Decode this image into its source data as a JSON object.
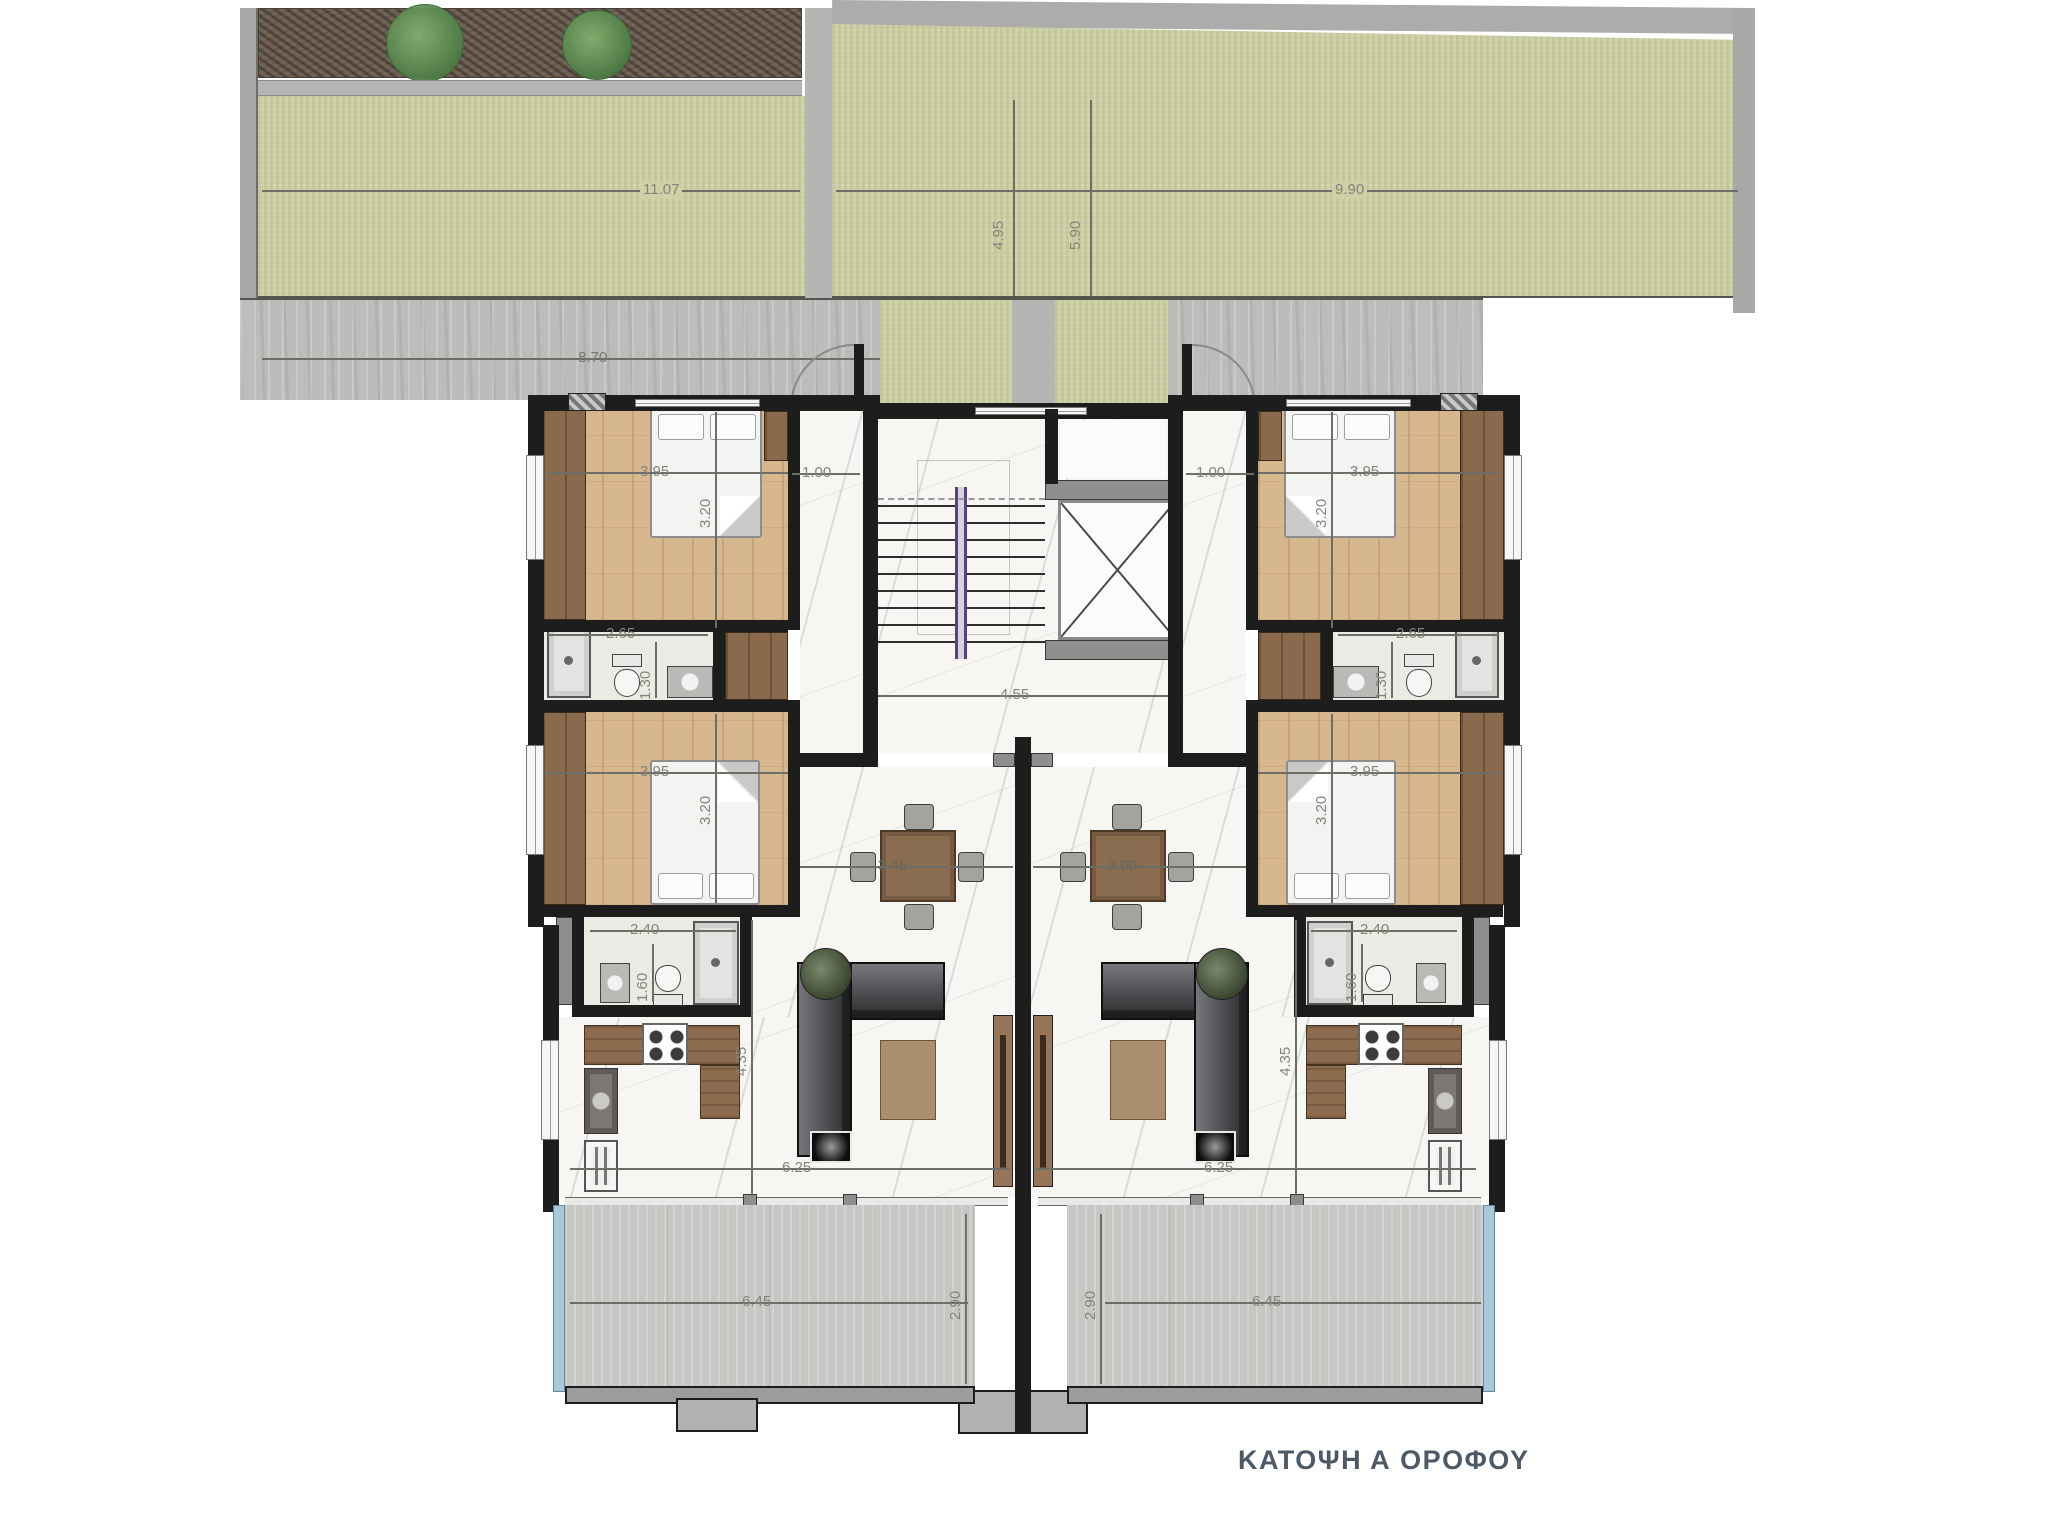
{
  "title": "ΚΑΤΟΨΗ Α ΟΡΟΦΟΥ",
  "palette": {
    "wall": "#1d1d1d",
    "wood_floor": "#d7b78d",
    "marble_floor": "#f7f6f3",
    "grass": "#cdd0a4",
    "glass_railing": "#a9c9da",
    "title_text": "#4d5a66"
  },
  "site_dims": {
    "garden_left_length": "11.07",
    "garden_right_length": "9.90",
    "garden_depth_a": "4.95",
    "garden_depth_b": "5.90",
    "walkway_length": "8.70"
  },
  "core_dims": {
    "corridor_width": "4.55"
  },
  "left_apartment": {
    "bedroom1_width": "3.95",
    "bedroom1_depth": "3.20",
    "entry_width": "1.00",
    "bathroom1_width": "2.65",
    "bathroom1_depth": "1.30",
    "bedroom2_width": "3.95",
    "bedroom2_depth": "3.20",
    "bathroom2_width": "2.40",
    "bathroom2_depth": "1.60",
    "dining_width": "3.45",
    "living_depth": "4.35",
    "living_width": "6.25",
    "balcony_width": "6.45",
    "balcony_depth": "2.90"
  },
  "right_apartment": {
    "bedroom1_width": "3.95",
    "bedroom1_depth": "3.20",
    "entry_width": "1.00",
    "bathroom1_width": "2.65",
    "bathroom1_depth": "1.30",
    "bedroom2_width": "3.95",
    "bedroom2_depth": "3.20",
    "bathroom2_width": "2.40",
    "bathroom2_depth": "1.60",
    "dining_width": "3.00",
    "living_depth": "4.35",
    "living_width": "6.25",
    "balcony_width": "6.45",
    "balcony_depth": "2.90"
  }
}
